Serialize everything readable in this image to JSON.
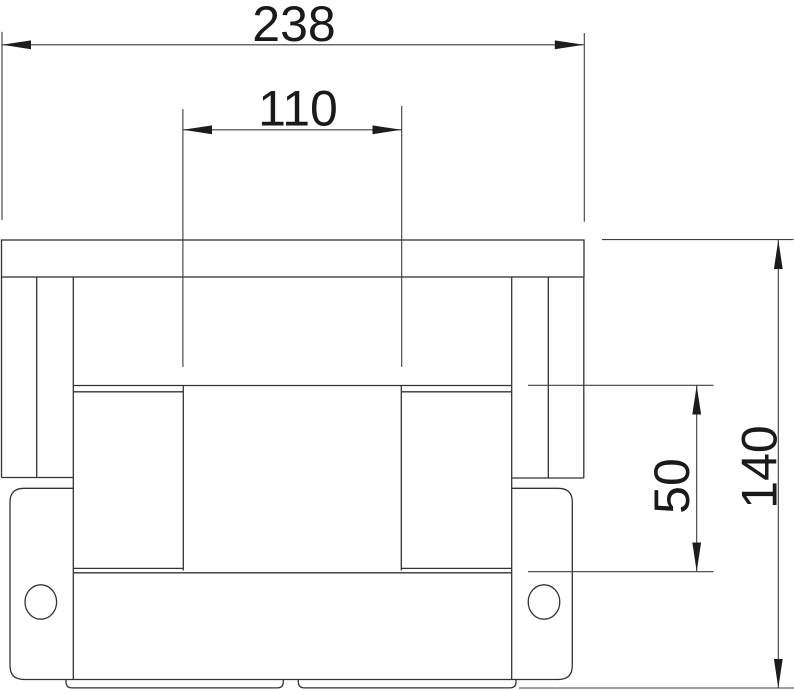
{
  "drawing": {
    "kind": "technical-dimension-drawing",
    "background_color": "#ffffff",
    "line_color": "#333333",
    "dimension_line_color": "#3d3d3d",
    "text_color": "#1a1a1a"
  },
  "dimensions": {
    "overall_width": {
      "value": "238"
    },
    "inner_width": {
      "value": "110"
    },
    "overall_height": {
      "value": "140"
    },
    "step_height": {
      "value": "50"
    }
  }
}
